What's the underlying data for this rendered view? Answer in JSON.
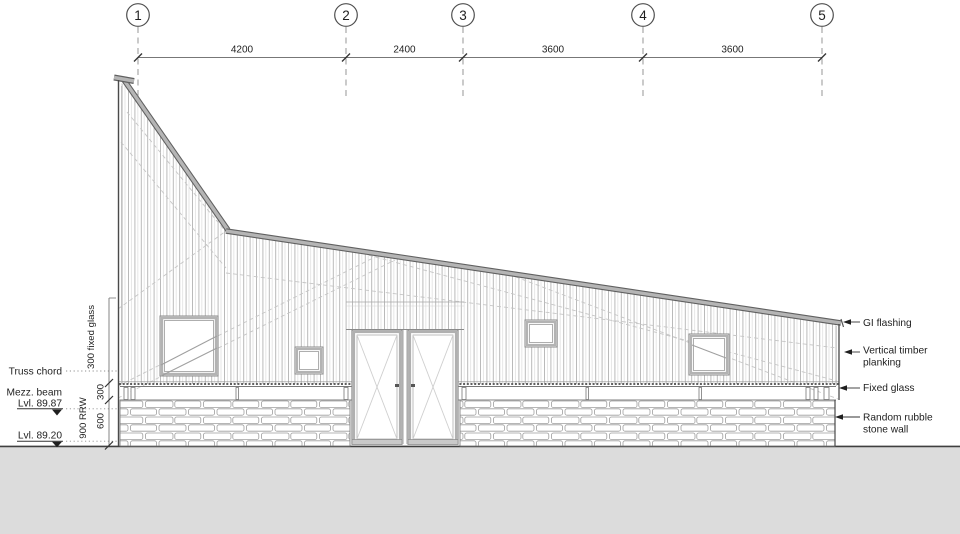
{
  "grid": {
    "bubbles": [
      "1",
      "2",
      "3",
      "4",
      "5"
    ],
    "spans": [
      "4200",
      "2400",
      "3600",
      "3600"
    ]
  },
  "left_annotations": {
    "truss_chord": "Truss chord",
    "mezz_beam": "Mezz. beam",
    "mezz_level": "Lvl. 89.87",
    "ground_level": "Lvl. 89.20",
    "dim_fixed_glass": "300 fixed glass",
    "dim_rrw": "900 RRW",
    "dim_300": "300",
    "dim_600": "600"
  },
  "callouts": [
    {
      "lines": [
        "GI flashing"
      ]
    },
    {
      "lines": [
        "Vertical timber",
        "planking"
      ]
    },
    {
      "lines": [
        "Fixed glass"
      ]
    },
    {
      "lines": [
        "Random rubble",
        "stone wall"
      ]
    }
  ],
  "colors": {
    "ground": "#dcdcdc",
    "flashing": "#b5b5b5",
    "flashing_edge": "#606060",
    "line_dark": "#3f3f3f"
  }
}
